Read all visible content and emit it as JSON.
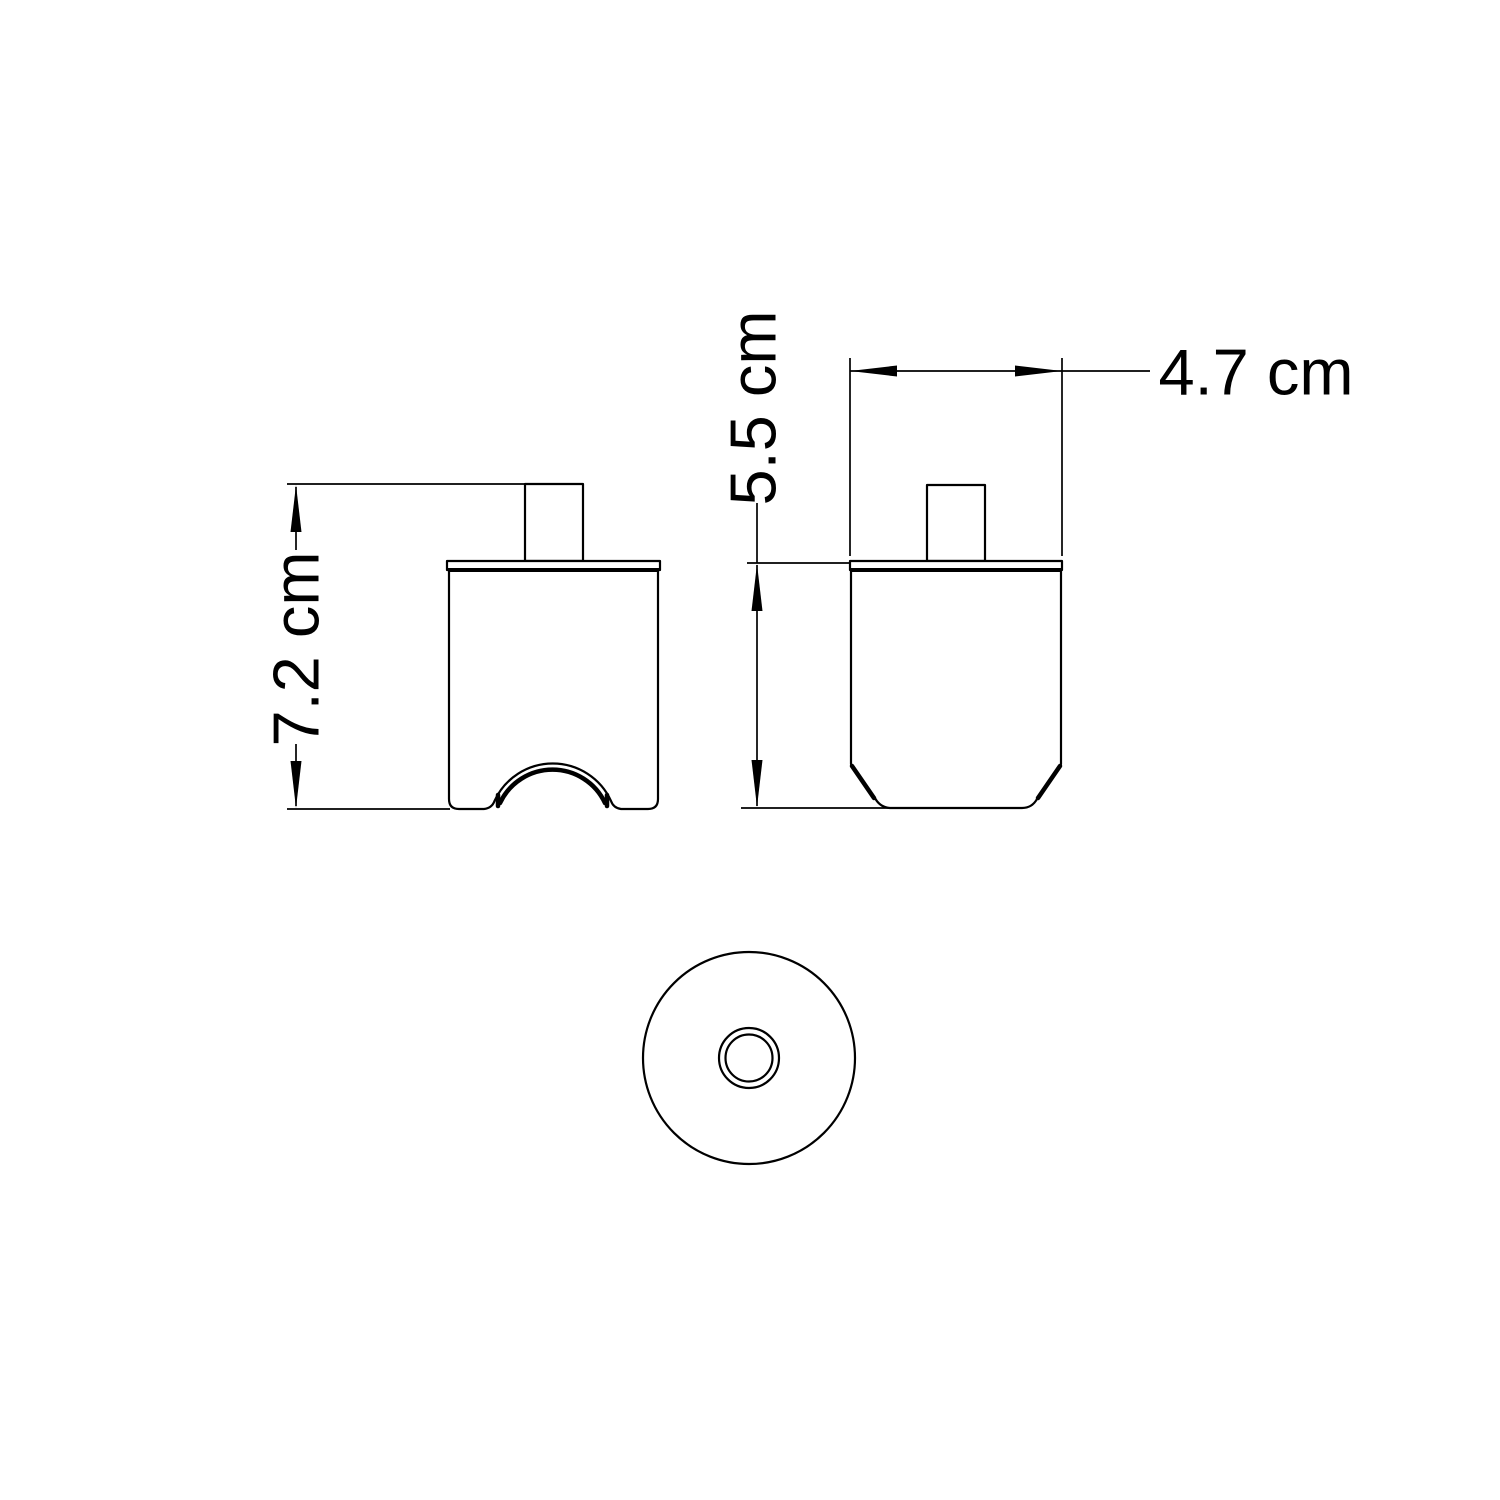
{
  "drawing": {
    "background_color": "#ffffff",
    "line_color": "#000000",
    "dimension_labels": {
      "front_height": "7.2 cm",
      "side_height": "5.5 cm",
      "side_width": "4.7 cm"
    }
  }
}
